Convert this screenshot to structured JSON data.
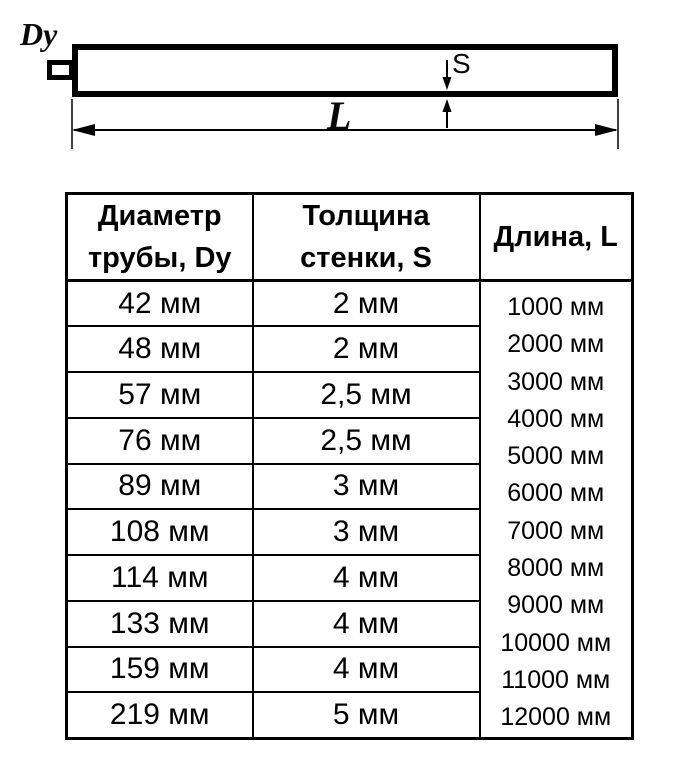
{
  "diagram": {
    "dy_label": "Dy",
    "s_label": "S",
    "l_label": "L",
    "line_color": "#000000",
    "fill_color": "#ffffff"
  },
  "table": {
    "headers": {
      "diameter": "Диаметр\nтрубы, Dy",
      "thickness": "Толщина\nстенки, S",
      "length": "Длина, L"
    },
    "rows": [
      {
        "diameter": "42 мм",
        "thickness": "2 мм"
      },
      {
        "diameter": "48 мм",
        "thickness": "2 мм"
      },
      {
        "diameter": "57 мм",
        "thickness": "2,5 мм"
      },
      {
        "diameter": "76 мм",
        "thickness": "2,5 мм"
      },
      {
        "diameter": "89 мм",
        "thickness": "3 мм"
      },
      {
        "diameter": "108 мм",
        "thickness": "3 мм"
      },
      {
        "diameter": "114 мм",
        "thickness": "4 мм"
      },
      {
        "diameter": "133 мм",
        "thickness": "4 мм"
      },
      {
        "diameter": "159 мм",
        "thickness": "4 мм"
      },
      {
        "diameter": "219 мм",
        "thickness": "5 мм"
      }
    ],
    "lengths": [
      "1000 мм",
      "2000 мм",
      "3000 мм",
      "4000 мм",
      "5000 мм",
      "6000 мм",
      "7000 мм",
      "8000 мм",
      "9000 мм",
      "10000 мм",
      "11000 мм",
      "12000 мм"
    ]
  }
}
